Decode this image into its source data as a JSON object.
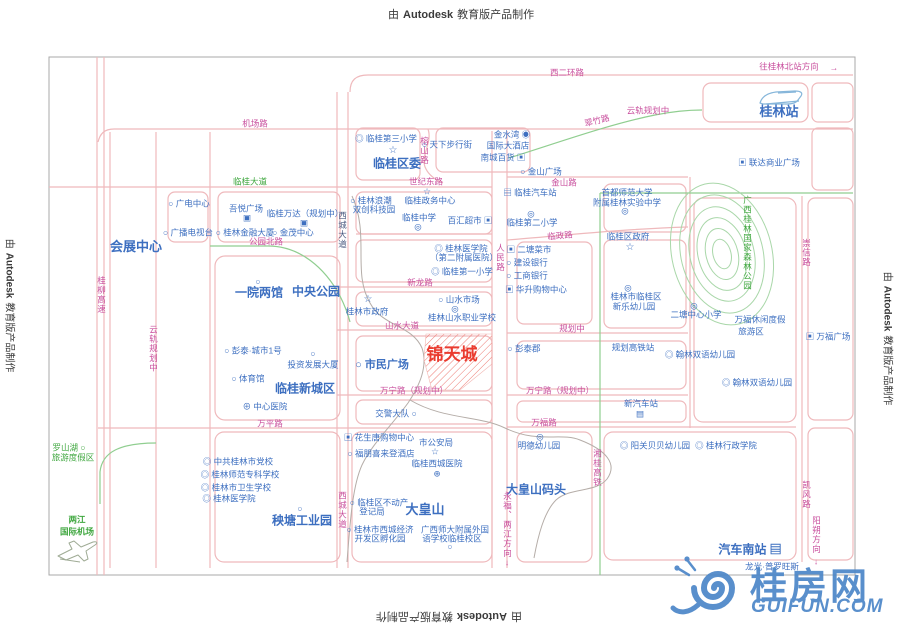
{
  "stamps": {
    "prefix": "由",
    "brand": "Autodesk",
    "suffix": "教育版产品制作"
  },
  "watermark": {
    "name": "桂房网",
    "domain": "GUIFUN.COM"
  },
  "project": {
    "name": "锦天城"
  },
  "colors": {
    "road_line": "#EFB9BC",
    "road_label": "#C9509E",
    "poi": "#3D6FC0",
    "green_label": "#3FA73F",
    "green_line": "#90CE90",
    "forest": "#A9D7A9",
    "river": "#B5ADA8",
    "red": "#EA3B2F",
    "dark": "#4A5A80",
    "border": "#A9A9A9",
    "stamp": "#3A3A3A",
    "watermark": "#4C86C8",
    "hatch": "#ED7A72"
  },
  "map": {
    "labels": [
      {
        "t": "西二环路",
        "x": 567,
        "y": 73,
        "c": "road"
      },
      {
        "t": "往桂林北站方向",
        "x": 789,
        "y": 67,
        "c": "road"
      },
      {
        "t": "→",
        "x": 834,
        "y": 68,
        "c": "road"
      },
      {
        "t": "机场路",
        "x": 255,
        "y": 124,
        "c": "road"
      },
      {
        "t": "云轨规划中",
        "x": 648,
        "y": 111,
        "c": "road"
      },
      {
        "t": "翠竹路",
        "x": 597,
        "y": 121,
        "c": "road",
        "r": -14
      },
      {
        "t": "桂林站",
        "x": 779,
        "y": 112,
        "c": "poi",
        "s": 13,
        "b": true
      },
      {
        "t": "◎ 临桂第三小学",
        "x": 386,
        "y": 139,
        "c": "poi"
      },
      {
        "t": "☆",
        "x": 393,
        "y": 151,
        "c": "poi",
        "s": 10
      },
      {
        "t": "临桂区委",
        "x": 397,
        "y": 164,
        "c": "poi",
        "s": 12,
        "b": true
      },
      {
        "t": "榕山路",
        "x": 424,
        "y": 151,
        "c": "road",
        "v": true
      },
      {
        "t": "○ 天下步行街",
        "x": 447,
        "y": 145,
        "c": "poi"
      },
      {
        "t": "金水湾 ◉",
        "x": 512,
        "y": 135,
        "c": "poi"
      },
      {
        "t": "国际大酒店",
        "x": 508,
        "y": 146,
        "c": "poi"
      },
      {
        "t": "南城百货 ▣",
        "x": 503,
        "y": 158,
        "c": "poi"
      },
      {
        "t": "○ 金山广场",
        "x": 541,
        "y": 172,
        "c": "poi"
      },
      {
        "t": "金山路",
        "x": 564,
        "y": 183,
        "c": "road"
      },
      {
        "t": "临桂大道",
        "x": 250,
        "y": 182,
        "c": "green"
      },
      {
        "t": "世纪东路",
        "x": 426,
        "y": 182,
        "c": "road"
      },
      {
        "t": "○ 广电中心",
        "x": 189,
        "y": 204,
        "c": "poi"
      },
      {
        "t": "○ 广播电视台",
        "x": 188,
        "y": 233,
        "c": "poi"
      },
      {
        "t": "吾悦广场",
        "x": 246,
        "y": 209,
        "c": "poi"
      },
      {
        "t": "▣",
        "x": 247,
        "y": 218,
        "c": "poi"
      },
      {
        "t": "临桂万达（规划中）",
        "x": 305,
        "y": 214,
        "c": "poi"
      },
      {
        "t": "▣",
        "x": 304,
        "y": 223,
        "c": "poi"
      },
      {
        "t": "○ 桂林金融大厦",
        "x": 245,
        "y": 233,
        "c": "poi"
      },
      {
        "t": "○ 金茂中心",
        "x": 293,
        "y": 233,
        "c": "poi"
      },
      {
        "t": "公园北路",
        "x": 266,
        "y": 242,
        "c": "road"
      },
      {
        "t": "会展中心",
        "x": 136,
        "y": 247,
        "c": "poi",
        "s": 13,
        "b": true
      },
      {
        "t": "▣ 联达商业广场",
        "x": 769,
        "y": 163,
        "c": "poi"
      },
      {
        "t": "○ 桂林浪潮",
        "x": 371,
        "y": 201,
        "c": "poi"
      },
      {
        "t": "双创科技园",
        "x": 374,
        "y": 210,
        "c": "poi"
      },
      {
        "t": "☆",
        "x": 427,
        "y": 192,
        "c": "poi",
        "s": 9
      },
      {
        "t": "临桂政务中心",
        "x": 430,
        "y": 201,
        "c": "poi"
      },
      {
        "t": "临桂中学",
        "x": 419,
        "y": 218,
        "c": "poi"
      },
      {
        "t": "◎",
        "x": 418,
        "y": 227,
        "c": "poi"
      },
      {
        "t": "百汇超市 ▣",
        "x": 470,
        "y": 221,
        "c": "poi"
      },
      {
        "t": "西城大道",
        "x": 342,
        "y": 230,
        "c": "dark",
        "v": true
      },
      {
        "t": "▤ 临桂汽车站",
        "x": 530,
        "y": 193,
        "c": "poi"
      },
      {
        "t": "◎",
        "x": 531,
        "y": 214,
        "c": "poi"
      },
      {
        "t": "临桂第二小学",
        "x": 532,
        "y": 223,
        "c": "poi"
      },
      {
        "t": "首都师范大学",
        "x": 627,
        "y": 193,
        "c": "poi"
      },
      {
        "t": "附属桂林实验中学",
        "x": 627,
        "y": 203,
        "c": "poi"
      },
      {
        "t": "◎",
        "x": 625,
        "y": 211,
        "c": "poi"
      },
      {
        "t": "临政路",
        "x": 560,
        "y": 236,
        "c": "road",
        "r": -5
      },
      {
        "t": "临桂区政府",
        "x": 628,
        "y": 237,
        "c": "poi"
      },
      {
        "t": "☆",
        "x": 630,
        "y": 248,
        "c": "poi",
        "s": 10
      },
      {
        "t": "广西桂林国家森林公园",
        "x": 747,
        "y": 243,
        "c": "green",
        "v": true
      },
      {
        "t": "崇信路",
        "x": 806,
        "y": 253,
        "c": "road",
        "v": true
      },
      {
        "t": "人民路",
        "x": 500,
        "y": 258,
        "c": "road",
        "v": true
      },
      {
        "t": "▣ 二塘菜市",
        "x": 529,
        "y": 250,
        "c": "poi"
      },
      {
        "t": "○ 建设银行",
        "x": 527,
        "y": 263,
        "c": "poi"
      },
      {
        "t": "○ 工商银行",
        "x": 527,
        "y": 276,
        "c": "poi"
      },
      {
        "t": "▣ 华升购物中心",
        "x": 536,
        "y": 290,
        "c": "poi"
      },
      {
        "t": "◎ 桂林医学院",
        "x": 461,
        "y": 249,
        "c": "poi"
      },
      {
        "t": "（第二附属医院）",
        "x": 464,
        "y": 258,
        "c": "poi"
      },
      {
        "t": "◎ 临桂第一小学",
        "x": 462,
        "y": 272,
        "c": "poi"
      },
      {
        "t": "新龙路",
        "x": 420,
        "y": 283,
        "c": "road"
      },
      {
        "t": "○",
        "x": 258,
        "y": 282,
        "c": "poi"
      },
      {
        "t": "一院两馆",
        "x": 259,
        "y": 293,
        "c": "poi",
        "s": 12,
        "b": true
      },
      {
        "t": "中央公园",
        "x": 316,
        "y": 292,
        "c": "poi",
        "s": 12,
        "b": true
      },
      {
        "t": "◎",
        "x": 628,
        "y": 288,
        "c": "poi"
      },
      {
        "t": "桂林市临桂区",
        "x": 636,
        "y": 297,
        "c": "poi"
      },
      {
        "t": "新乐幼儿园",
        "x": 634,
        "y": 307,
        "c": "poi"
      },
      {
        "t": "☆",
        "x": 368,
        "y": 300,
        "c": "poi",
        "s": 10
      },
      {
        "t": "桂林市政府",
        "x": 367,
        "y": 312,
        "c": "poi"
      },
      {
        "t": "○ 山水市场",
        "x": 459,
        "y": 300,
        "c": "poi"
      },
      {
        "t": "◎",
        "x": 455,
        "y": 309,
        "c": "poi"
      },
      {
        "t": "桂林山水职业学校",
        "x": 462,
        "y": 318,
        "c": "poi"
      },
      {
        "t": "◎",
        "x": 694,
        "y": 306,
        "c": "poi"
      },
      {
        "t": "二塘中心小学",
        "x": 696,
        "y": 315,
        "c": "poi"
      },
      {
        "t": "山水大道",
        "x": 402,
        "y": 326,
        "c": "road"
      },
      {
        "t": "规划中",
        "x": 572,
        "y": 329,
        "c": "road"
      },
      {
        "t": "万福休闲度假",
        "x": 760,
        "y": 320,
        "c": "poi"
      },
      {
        "t": "旅游区",
        "x": 751,
        "y": 332,
        "c": "poi"
      },
      {
        "t": "▣ 万福广场",
        "x": 828,
        "y": 337,
        "c": "poi"
      },
      {
        "t": "○ 彭泰·城市1号",
        "x": 253,
        "y": 351,
        "c": "poi"
      },
      {
        "t": "○",
        "x": 313,
        "y": 354,
        "c": "poi"
      },
      {
        "t": "投资发展大厦",
        "x": 313,
        "y": 365,
        "c": "poi"
      },
      {
        "t": "○ 体育馆",
        "x": 248,
        "y": 379,
        "c": "poi"
      },
      {
        "t": "临桂新城区",
        "x": 305,
        "y": 389,
        "c": "poi",
        "s": 12,
        "b": true
      },
      {
        "t": "⊕ 中心医院",
        "x": 265,
        "y": 407,
        "c": "poi"
      },
      {
        "t": "锦天城",
        "x": 452,
        "y": 355,
        "c": "red",
        "s": 17,
        "b": true
      },
      {
        "t": "○ 市民广场",
        "x": 382,
        "y": 366,
        "c": "poi",
        "s": 11,
        "b": true
      },
      {
        "t": "○ 彭泰郡",
        "x": 524,
        "y": 349,
        "c": "poi"
      },
      {
        "t": "规划高铁站",
        "x": 633,
        "y": 348,
        "c": "poi"
      },
      {
        "t": "◎ 翰林双语幼儿园",
        "x": 700,
        "y": 355,
        "c": "poi"
      },
      {
        "t": "◎ 翰林双语幼儿园",
        "x": 757,
        "y": 383,
        "c": "poi"
      },
      {
        "t": "云轨规划中",
        "x": 153,
        "y": 349,
        "c": "road",
        "v": true
      },
      {
        "t": "桂柳高速",
        "x": 101,
        "y": 295,
        "c": "road",
        "v": true
      },
      {
        "t": "万宁路（规划中）",
        "x": 414,
        "y": 391,
        "c": "road"
      },
      {
        "t": "万宁路（规划中）",
        "x": 560,
        "y": 391,
        "c": "road"
      },
      {
        "t": "新汽车站",
        "x": 641,
        "y": 404,
        "c": "poi"
      },
      {
        "t": "▤",
        "x": 640,
        "y": 414,
        "c": "poi"
      },
      {
        "t": "万平路",
        "x": 270,
        "y": 424,
        "c": "road"
      },
      {
        "t": "万福路",
        "x": 544,
        "y": 423,
        "c": "road"
      },
      {
        "t": "交警大队 ○",
        "x": 396,
        "y": 414,
        "c": "poi"
      },
      {
        "t": "▣ 花生唐购物中心",
        "x": 379,
        "y": 438,
        "c": "poi"
      },
      {
        "t": "○ 福朋喜来登酒店",
        "x": 381,
        "y": 454,
        "c": "poi"
      },
      {
        "t": "市公安局",
        "x": 436,
        "y": 443,
        "c": "poi"
      },
      {
        "t": "☆",
        "x": 435,
        "y": 452,
        "c": "poi",
        "s": 9
      },
      {
        "t": "临桂西城医院",
        "x": 437,
        "y": 464,
        "c": "poi"
      },
      {
        "t": "⊕",
        "x": 437,
        "y": 474,
        "c": "poi"
      },
      {
        "t": "◎",
        "x": 540,
        "y": 437,
        "c": "poi"
      },
      {
        "t": "明德幼儿园",
        "x": 539,
        "y": 446,
        "c": "poi"
      },
      {
        "t": "大皇山码头",
        "x": 536,
        "y": 490,
        "c": "poi",
        "s": 12,
        "b": true
      },
      {
        "t": "湘桂高铁",
        "x": 597,
        "y": 468,
        "c": "road",
        "v": true
      },
      {
        "t": "永福、两江方向",
        "x": 507,
        "y": 525,
        "c": "road",
        "v": true
      },
      {
        "t": "↓",
        "x": 507,
        "y": 563,
        "c": "road"
      },
      {
        "t": "西城大道",
        "x": 342,
        "y": 510,
        "c": "road",
        "v": true
      },
      {
        "t": "○ 临桂区不动产",
        "x": 379,
        "y": 503,
        "c": "poi"
      },
      {
        "t": "登记局",
        "x": 372,
        "y": 512,
        "c": "poi"
      },
      {
        "t": "大皇山",
        "x": 425,
        "y": 510,
        "c": "poi",
        "s": 13,
        "b": true
      },
      {
        "t": "○ 桂林市西城经济",
        "x": 380,
        "y": 530,
        "c": "poi"
      },
      {
        "t": "开发区孵化园",
        "x": 380,
        "y": 539,
        "c": "poi"
      },
      {
        "t": "广西师大附属外国",
        "x": 455,
        "y": 530,
        "c": "poi"
      },
      {
        "t": "语学校临桂校区",
        "x": 452,
        "y": 539,
        "c": "poi"
      },
      {
        "t": "○",
        "x": 450,
        "y": 547,
        "c": "poi"
      },
      {
        "t": "罗山湖 ○",
        "x": 69,
        "y": 448,
        "c": "green"
      },
      {
        "t": "旅游度假区",
        "x": 73,
        "y": 458,
        "c": "green"
      },
      {
        "t": "◎ 中共桂林市党校",
        "x": 238,
        "y": 462,
        "c": "poi"
      },
      {
        "t": "◎ 桂林师范专科学校",
        "x": 240,
        "y": 475,
        "c": "poi"
      },
      {
        "t": "◎ 桂林市卫生学校",
        "x": 236,
        "y": 488,
        "c": "poi"
      },
      {
        "t": "◎ 桂林医学院",
        "x": 229,
        "y": 499,
        "c": "poi"
      },
      {
        "t": "○",
        "x": 300,
        "y": 509,
        "c": "poi"
      },
      {
        "t": "秧塘工业园",
        "x": 302,
        "y": 521,
        "c": "poi",
        "s": 12,
        "b": true
      },
      {
        "t": "两江",
        "x": 77,
        "y": 520,
        "c": "green",
        "b": true
      },
      {
        "t": "国际机场",
        "x": 77,
        "y": 532,
        "c": "green",
        "b": true
      },
      {
        "t": "◎ 阳关贝贝幼儿园",
        "x": 655,
        "y": 446,
        "c": "poi"
      },
      {
        "t": "◎ 桂林行政学院",
        "x": 726,
        "y": 446,
        "c": "poi"
      },
      {
        "t": "凯风路",
        "x": 806,
        "y": 495,
        "c": "road",
        "v": true
      },
      {
        "t": "阳朔方向",
        "x": 816,
        "y": 535,
        "c": "road",
        "v": true
      },
      {
        "t": "↓",
        "x": 816,
        "y": 562,
        "c": "road"
      },
      {
        "t": "汽车南站 ▤",
        "x": 750,
        "y": 550,
        "c": "poi",
        "s": 12,
        "b": true
      },
      {
        "t": "龙光·普罗旺斯",
        "x": 772,
        "y": 567,
        "c": "poi"
      }
    ]
  }
}
